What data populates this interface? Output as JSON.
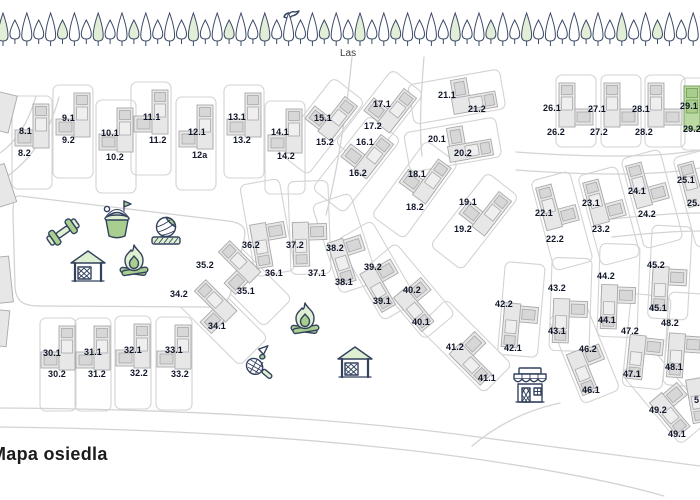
{
  "title": "Mapa osiedla",
  "forest": {
    "label": "Las",
    "tree_count": 59
  },
  "highlighted_house": "29",
  "colors": {
    "house_fill": "#e7e7e7",
    "house_mid": "#d7d7d7",
    "house_light": "#efefef",
    "house_stroke": "#a9a9a9",
    "highlight_fill": "#bcd9a4",
    "highlight_mid": "#a9cd8e",
    "highlight_stroke": "#78a35c",
    "icon_green": "#a8cf8f",
    "icon_green_light": "#dff0d2",
    "icon_stroke": "#33415e",
    "road": "#d3d3d3",
    "label": "#10162a",
    "tree_stroke": "#3b4a68",
    "tree_fill_green": "#e3eed7",
    "tree_fill_white": "#ffffff"
  },
  "houses": [
    {
      "n": "8",
      "x": 32,
      "y": 127,
      "labels": [
        {
          "t": "8.1",
          "x": 19,
          "y": 134
        },
        {
          "t": "8.2",
          "x": 18,
          "y": 156
        }
      ]
    },
    {
      "n": "9",
      "x": 73,
      "y": 116,
      "labels": [
        {
          "t": "9.1",
          "x": 62,
          "y": 121
        },
        {
          "t": "9.2",
          "x": 62,
          "y": 143
        }
      ]
    },
    {
      "n": "10",
      "x": 116,
      "y": 131,
      "labels": [
        {
          "t": "10.1",
          "x": 101,
          "y": 136
        },
        {
          "t": "10.2",
          "x": 106,
          "y": 160
        }
      ]
    },
    {
      "n": "11",
      "x": 151,
      "y": 113,
      "labels": [
        {
          "t": "11.1",
          "x": 143,
          "y": 120
        },
        {
          "t": "11.2",
          "x": 149,
          "y": 143
        }
      ]
    },
    {
      "n": "12",
      "x": 196,
      "y": 128,
      "labels": [
        {
          "t": "12.1",
          "x": 188,
          "y": 135
        },
        {
          "t": "12a",
          "x": 192,
          "y": 158
        }
      ]
    },
    {
      "n": "13",
      "x": 244,
      "y": 116,
      "labels": [
        {
          "t": "13.1",
          "x": 228,
          "y": 120
        },
        {
          "t": "13.2",
          "x": 233,
          "y": 143
        }
      ]
    },
    {
      "n": "14",
      "x": 285,
      "y": 132,
      "labels": [
        {
          "t": "14.1",
          "x": 271,
          "y": 135
        },
        {
          "t": "14.2",
          "x": 277,
          "y": 159
        }
      ]
    },
    {
      "n": "15",
      "x": 330,
      "y": 114,
      "r": 38,
      "labels": [
        {
          "t": "15.1",
          "x": 314,
          "y": 121
        },
        {
          "t": "15.2",
          "x": 316,
          "y": 145
        }
      ]
    },
    {
      "n": "16",
      "x": 366,
      "y": 152,
      "r": 38,
      "labels": [
        {
          "t": "16.1",
          "x": 356,
          "y": 145
        },
        {
          "t": "16.2",
          "x": 349,
          "y": 176
        }
      ]
    },
    {
      "n": "17",
      "x": 389,
      "y": 106,
      "r": 38,
      "labels": [
        {
          "t": "17.1",
          "x": 373,
          "y": 107
        },
        {
          "t": "17.2",
          "x": 364,
          "y": 129
        }
      ]
    },
    {
      "n": "18",
      "x": 424,
      "y": 177,
      "r": 36,
      "labels": [
        {
          "t": "18.1",
          "x": 408,
          "y": 177
        },
        {
          "t": "18.2",
          "x": 406,
          "y": 210
        }
      ]
    },
    {
      "n": "19",
      "x": 484,
      "y": 209,
      "r": 38,
      "labels": [
        {
          "t": "19.1",
          "x": 459,
          "y": 205
        },
        {
          "t": "19.2",
          "x": 454,
          "y": 232
        }
      ]
    },
    {
      "n": "20",
      "x": 468,
      "y": 142,
      "r": 80,
      "labels": [
        {
          "t": "20.1",
          "x": 428,
          "y": 142
        },
        {
          "t": "20.2",
          "x": 454,
          "y": 156
        }
      ]
    },
    {
      "n": "21",
      "x": 472,
      "y": 94,
      "r": 80,
      "labels": [
        {
          "t": "21.1",
          "x": 438,
          "y": 98
        },
        {
          "t": "21.2",
          "x": 468,
          "y": 112
        }
      ]
    },
    {
      "n": "22",
      "x": 558,
      "y": 206,
      "r": -15,
      "m": true,
      "labels": [
        {
          "t": "22.1",
          "x": 535,
          "y": 216
        },
        {
          "t": "22.2",
          "x": 546,
          "y": 242
        }
      ]
    },
    {
      "n": "23",
      "x": 605,
      "y": 201,
      "r": -15,
      "m": true,
      "labels": [
        {
          "t": "23.1",
          "x": 582,
          "y": 206
        },
        {
          "t": "23.2",
          "x": 592,
          "y": 232
        }
      ]
    },
    {
      "n": "24",
      "x": 648,
      "y": 184,
      "r": -15,
      "m": true,
      "labels": [
        {
          "t": "24.1",
          "x": 628,
          "y": 194
        },
        {
          "t": "24.2",
          "x": 638,
          "y": 217
        }
      ]
    },
    {
      "n": "25",
      "x": 700,
      "y": 183,
      "r": -15,
      "m": true,
      "labels": [
        {
          "t": "25.1",
          "x": 677,
          "y": 183
        },
        {
          "t": "25.2",
          "x": 687,
          "y": 206
        }
      ]
    },
    {
      "n": "26",
      "x": 576,
      "y": 106,
      "m": true,
      "lh": 72,
      "labels": [
        {
          "t": "26.1",
          "x": 543,
          "y": 111
        },
        {
          "t": "26.2",
          "x": 547,
          "y": 135
        }
      ]
    },
    {
      "n": "27",
      "x": 621,
      "y": 106,
      "m": true,
      "lh": 72,
      "labels": [
        {
          "t": "27.1",
          "x": 588,
          "y": 112
        },
        {
          "t": "27.2",
          "x": 590,
          "y": 135
        }
      ]
    },
    {
      "n": "28",
      "x": 665,
      "y": 106,
      "m": true,
      "lh": 72,
      "labels": [
        {
          "t": "28.1",
          "x": 632,
          "y": 112
        },
        {
          "t": "28.2",
          "x": 635,
          "y": 135
        }
      ]
    },
    {
      "n": "29",
      "x": 701,
      "y": 109,
      "m": true,
      "lh": 72,
      "hl": true,
      "labels": [
        {
          "t": "29.1",
          "x": 680,
          "y": 109
        },
        {
          "t": "29.2",
          "x": 683,
          "y": 132
        }
      ]
    },
    {
      "n": "30",
      "x": 58,
      "y": 349,
      "lw": 36,
      "labels": [
        {
          "t": "30.1",
          "x": 43,
          "y": 356
        },
        {
          "t": "30.2",
          "x": 48,
          "y": 377
        }
      ]
    },
    {
      "n": "31",
      "x": 93,
      "y": 349,
      "lw": 36,
      "labels": [
        {
          "t": "31.1",
          "x": 84,
          "y": 355
        },
        {
          "t": "31.2",
          "x": 88,
          "y": 377
        }
      ]
    },
    {
      "n": "32",
      "x": 133,
      "y": 347,
      "lw": 36,
      "labels": [
        {
          "t": "32.1",
          "x": 124,
          "y": 353
        },
        {
          "t": "32.2",
          "x": 130,
          "y": 376
        }
      ]
    },
    {
      "n": "33",
      "x": 174,
      "y": 348,
      "lw": 36,
      "labels": [
        {
          "t": "33.1",
          "x": 165,
          "y": 353
        },
        {
          "t": "33.2",
          "x": 171,
          "y": 377
        }
      ]
    },
    {
      "n": "34",
      "x": 210,
      "y": 308,
      "r": -45,
      "labels": [
        {
          "t": "34.1",
          "x": 208,
          "y": 329
        },
        {
          "t": "34.2",
          "x": 170,
          "y": 297
        }
      ]
    },
    {
      "n": "35",
      "x": 234,
      "y": 269,
      "r": -45,
      "labels": [
        {
          "t": "35.1",
          "x": 237,
          "y": 294
        },
        {
          "t": "35.2",
          "x": 196,
          "y": 268
        }
      ]
    },
    {
      "n": "36",
      "x": 270,
      "y": 243,
      "r": 170,
      "labels": [
        {
          "t": "36.1",
          "x": 265,
          "y": 276
        },
        {
          "t": "36.2",
          "x": 242,
          "y": 248
        }
      ]
    },
    {
      "n": "37",
      "x": 310,
      "y": 243,
      "r": 178,
      "labels": [
        {
          "t": "37.1",
          "x": 308,
          "y": 276
        },
        {
          "t": "37.2",
          "x": 286,
          "y": 248
        }
      ]
    },
    {
      "n": "38",
      "x": 350,
      "y": 258,
      "r": 162,
      "labels": [
        {
          "t": "38.1",
          "x": 335,
          "y": 285
        },
        {
          "t": "38.2",
          "x": 326,
          "y": 251
        }
      ]
    },
    {
      "n": "39",
      "x": 385,
      "y": 284,
      "r": 150,
      "labels": [
        {
          "t": "39.1",
          "x": 373,
          "y": 304
        },
        {
          "t": "39.2",
          "x": 364,
          "y": 270
        }
      ]
    },
    {
      "n": "40",
      "x": 420,
      "y": 303,
      "r": 140,
      "labels": [
        {
          "t": "40.1",
          "x": 412,
          "y": 325
        },
        {
          "t": "40.2",
          "x": 403,
          "y": 293
        }
      ]
    },
    {
      "n": "41",
      "x": 476,
      "y": 357,
      "r": 135,
      "labels": [
        {
          "t": "41.1",
          "x": 478,
          "y": 381
        },
        {
          "t": "41.2",
          "x": 446,
          "y": 350
        }
      ]
    },
    {
      "n": "42",
      "x": 520,
      "y": 325,
      "r": 185,
      "labels": [
        {
          "t": "42.1",
          "x": 504,
          "y": 351
        },
        {
          "t": "42.2",
          "x": 495,
          "y": 307
        }
      ]
    },
    {
      "n": "43",
      "x": 570,
      "y": 320,
      "r": 182,
      "labels": [
        {
          "t": "43.1",
          "x": 548,
          "y": 334
        },
        {
          "t": "43.2",
          "x": 548,
          "y": 291
        }
      ]
    },
    {
      "n": "44",
      "x": 618,
      "y": 306,
      "r": 182,
      "labels": [
        {
          "t": "44.1",
          "x": 598,
          "y": 323
        },
        {
          "t": "44.2",
          "x": 597,
          "y": 279
        }
      ]
    },
    {
      "n": "45",
      "x": 669,
      "y": 288,
      "r": 183,
      "labels": [
        {
          "t": "45.1",
          "x": 649,
          "y": 311
        },
        {
          "t": "45.2",
          "x": 647,
          "y": 268
        }
      ]
    },
    {
      "n": "46",
      "x": 590,
      "y": 368,
      "r": 158,
      "labels": [
        {
          "t": "46.1",
          "x": 582,
          "y": 393
        },
        {
          "t": "46.2",
          "x": 579,
          "y": 352
        }
      ]
    },
    {
      "n": "47",
      "x": 645,
      "y": 357,
      "r": 186,
      "labels": [
        {
          "t": "47.1",
          "x": 623,
          "y": 377
        },
        {
          "t": "47.2",
          "x": 621,
          "y": 334
        }
      ]
    },
    {
      "n": "48",
      "x": 685,
      "y": 355,
      "r": 184,
      "labels": [
        {
          "t": "48.1",
          "x": 665,
          "y": 370
        },
        {
          "t": "48.2",
          "x": 661,
          "y": 326
        }
      ]
    },
    {
      "n": "49",
      "x": 676,
      "y": 408,
      "r": 140,
      "labels": [
        {
          "t": "49.1",
          "x": 668,
          "y": 437
        },
        {
          "t": "49.2",
          "x": 649,
          "y": 413
        }
      ]
    },
    {
      "n": "50",
      "x": 706,
      "y": 398,
      "r": 170,
      "lot": false,
      "labels": [
        {
          "t": "5",
          "x": 694,
          "y": 403
        }
      ]
    }
  ],
  "edge_buildings": [
    {
      "x": 2,
      "y": 112,
      "w": 22,
      "h": 38,
      "r": 14
    },
    {
      "x": 0,
      "y": 186,
      "w": 22,
      "h": 40,
      "r": -18
    },
    {
      "x": 1,
      "y": 280,
      "w": 20,
      "h": 46,
      "r": -6
    },
    {
      "x": 0,
      "y": 328,
      "w": 16,
      "h": 36,
      "r": 6
    }
  ],
  "icons": [
    {
      "name": "dumbbell",
      "id": "outdoor-gym",
      "x": 63,
      "y": 232,
      "r": -35
    },
    {
      "name": "sand-bucket",
      "id": "sandbox",
      "x": 117,
      "y": 224,
      "r": 0
    },
    {
      "name": "volleyball",
      "id": "volleyball-court",
      "x": 166,
      "y": 230,
      "r": 0
    },
    {
      "name": "gazebo",
      "id": "gazebo-1",
      "x": 88,
      "y": 264,
      "r": 0
    },
    {
      "name": "campfire",
      "id": "campfire-1",
      "x": 134,
      "y": 262,
      "r": 0
    },
    {
      "name": "badminton",
      "id": "badminton-court",
      "x": 257,
      "y": 362,
      "r": -8
    },
    {
      "name": "campfire",
      "id": "campfire-2",
      "x": 305,
      "y": 320,
      "r": 0
    },
    {
      "name": "gazebo",
      "id": "gazebo-2",
      "x": 355,
      "y": 360,
      "r": 0
    },
    {
      "name": "shop",
      "id": "shop",
      "x": 530,
      "y": 386,
      "r": 0
    },
    {
      "name": "bird",
      "id": "bird",
      "x": 291,
      "y": 15,
      "r": 0
    }
  ]
}
